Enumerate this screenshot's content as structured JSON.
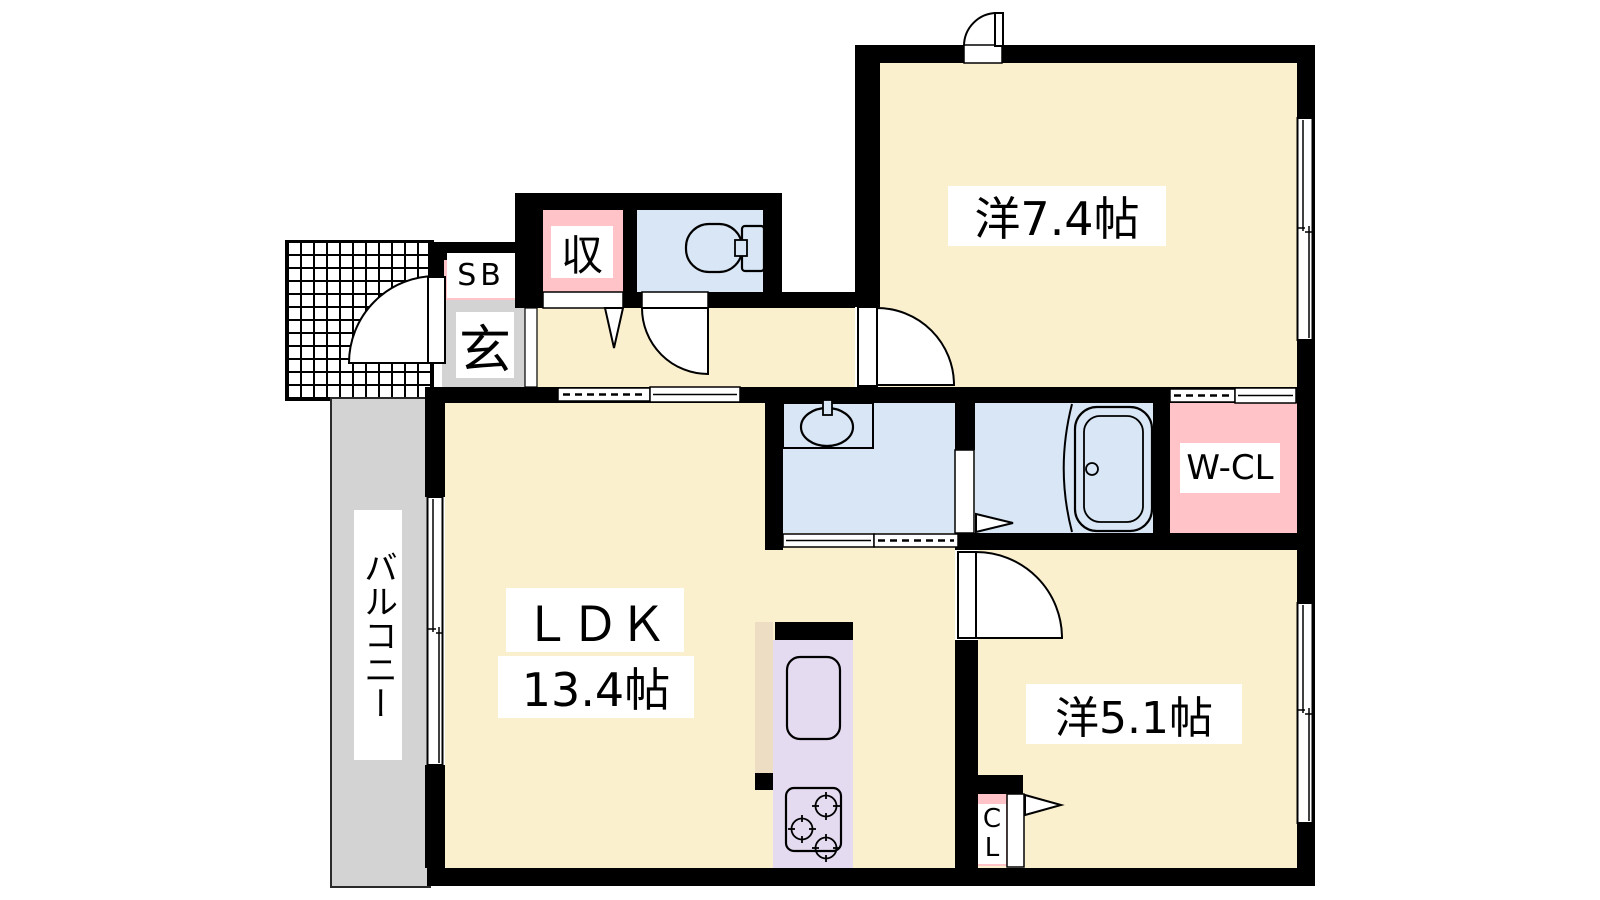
{
  "colors": {
    "wall": "#000000",
    "room_floor": "#FBF0CE",
    "wet_area": "#D8E6F5",
    "closet_fill": "#FFC3C8",
    "kitchen_counter": "#E5DBF1",
    "kitchen_side": "#EDDEC3",
    "balcony": "#D3D3D3",
    "label_bg": "#FFFFFF"
  },
  "rooms": {
    "western_room_74": {
      "label": "洋7.4帖"
    },
    "ldk": {
      "label": "ＬＤＫ",
      "size": "13.4帖"
    },
    "western_room_51": {
      "label": "洋5.1帖"
    },
    "balcony": {
      "label": "バルコニー"
    },
    "entrance": {
      "label": "玄"
    },
    "shoe_box": {
      "label": "SB"
    },
    "storage": {
      "label": "収"
    },
    "walk_in_closet": {
      "label": "W-CL"
    },
    "closet": {
      "label": "CL"
    }
  }
}
